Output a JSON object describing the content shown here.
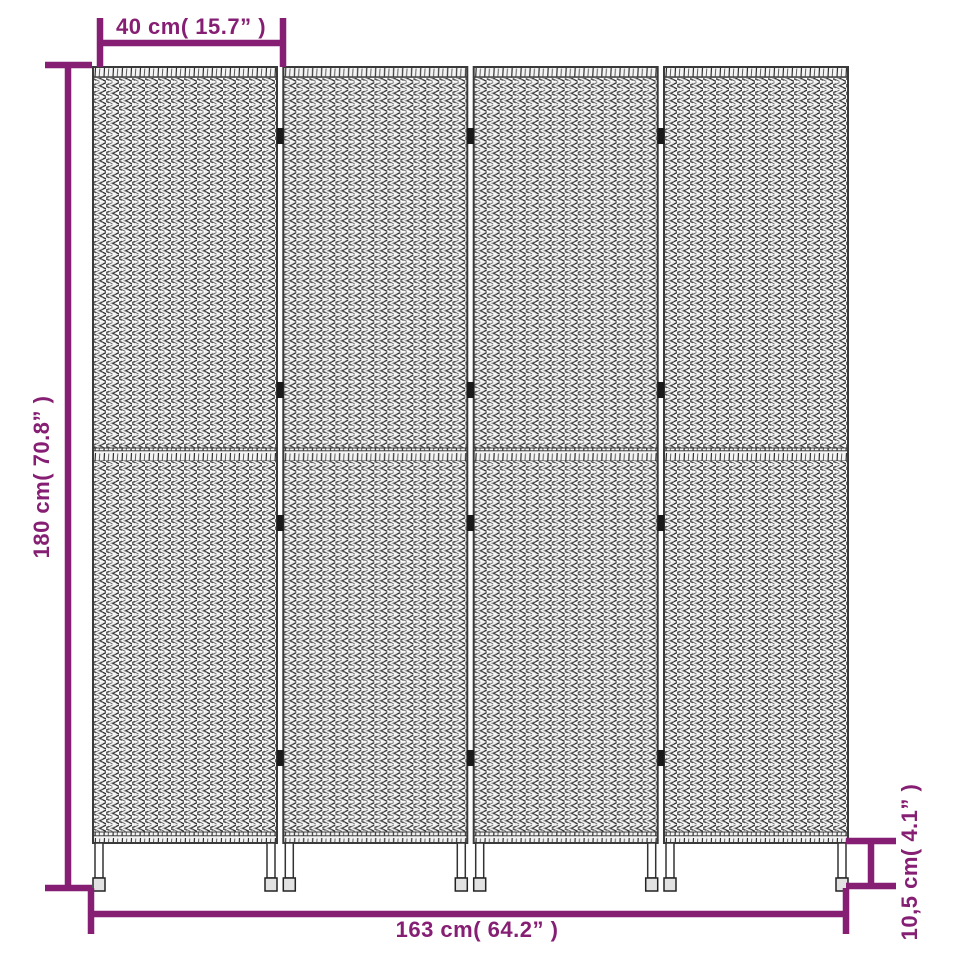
{
  "figure": {
    "type": "product-dimension-diagram",
    "subject": "4-panel woven room divider",
    "panel_count": 4,
    "accent_color": "#861F73",
    "weave_color": "#2f2f2f",
    "dimensions": {
      "panel_width": "40 cm( 15.7” )",
      "height": "180 cm( 70.8” )",
      "total_width": "163 cm( 64.2” )",
      "leg_height": "10,5 cm( 4.1” )"
    }
  }
}
